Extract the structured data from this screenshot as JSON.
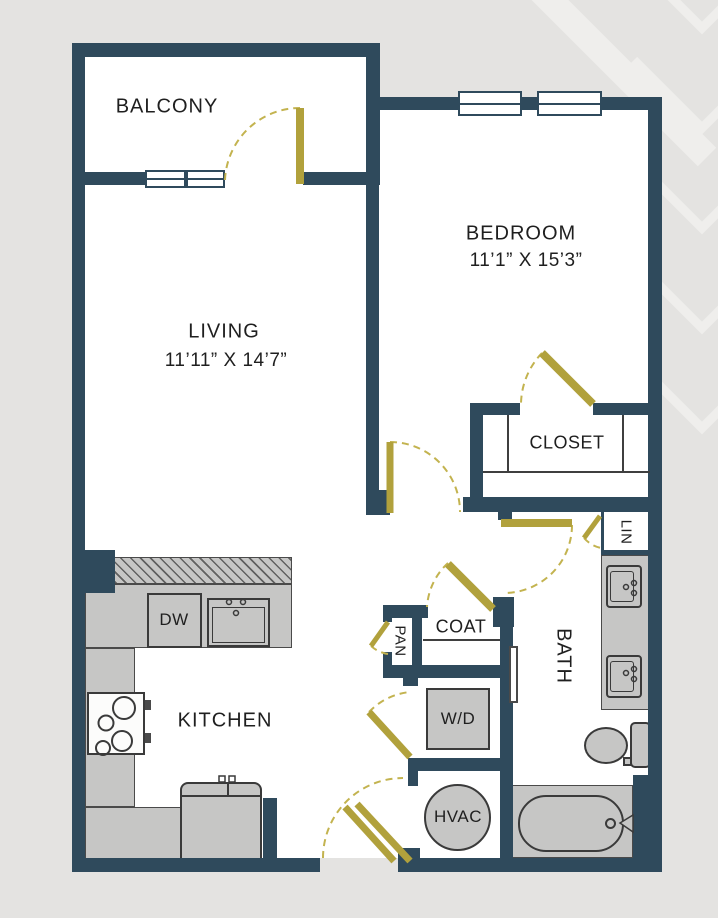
{
  "floorplan": {
    "rooms": {
      "balcony": {
        "label": "BALCONY"
      },
      "living": {
        "label": "LIVING",
        "dims": "11’11” X 14’7”"
      },
      "bedroom": {
        "label": "BEDROOM",
        "dims": "11’1” X 15’3”"
      },
      "kitchen": {
        "label": "KITCHEN"
      },
      "closet": {
        "label": "CLOSET"
      },
      "coat_closet": {
        "label": "COAT"
      },
      "pantry": {
        "label": "PAN"
      },
      "linen_closet": {
        "label": "LIN"
      },
      "bath": {
        "label": "BATH"
      },
      "washer_dryer": {
        "label": "W/D"
      },
      "hvac": {
        "label": "HVAC"
      },
      "dishwasher": {
        "label": "DW"
      }
    },
    "colors": {
      "bg": "#e4e3e1",
      "floor": "#ffffff",
      "wall": "#2f4a5c",
      "door": "#b1a13c",
      "door_arc": "#c3b34f",
      "fixture_fill": "#c6c6c5",
      "fixture_stroke": "#3a3a3a",
      "pattern": "#efeeec",
      "text": "#1f1f1f"
    }
  }
}
